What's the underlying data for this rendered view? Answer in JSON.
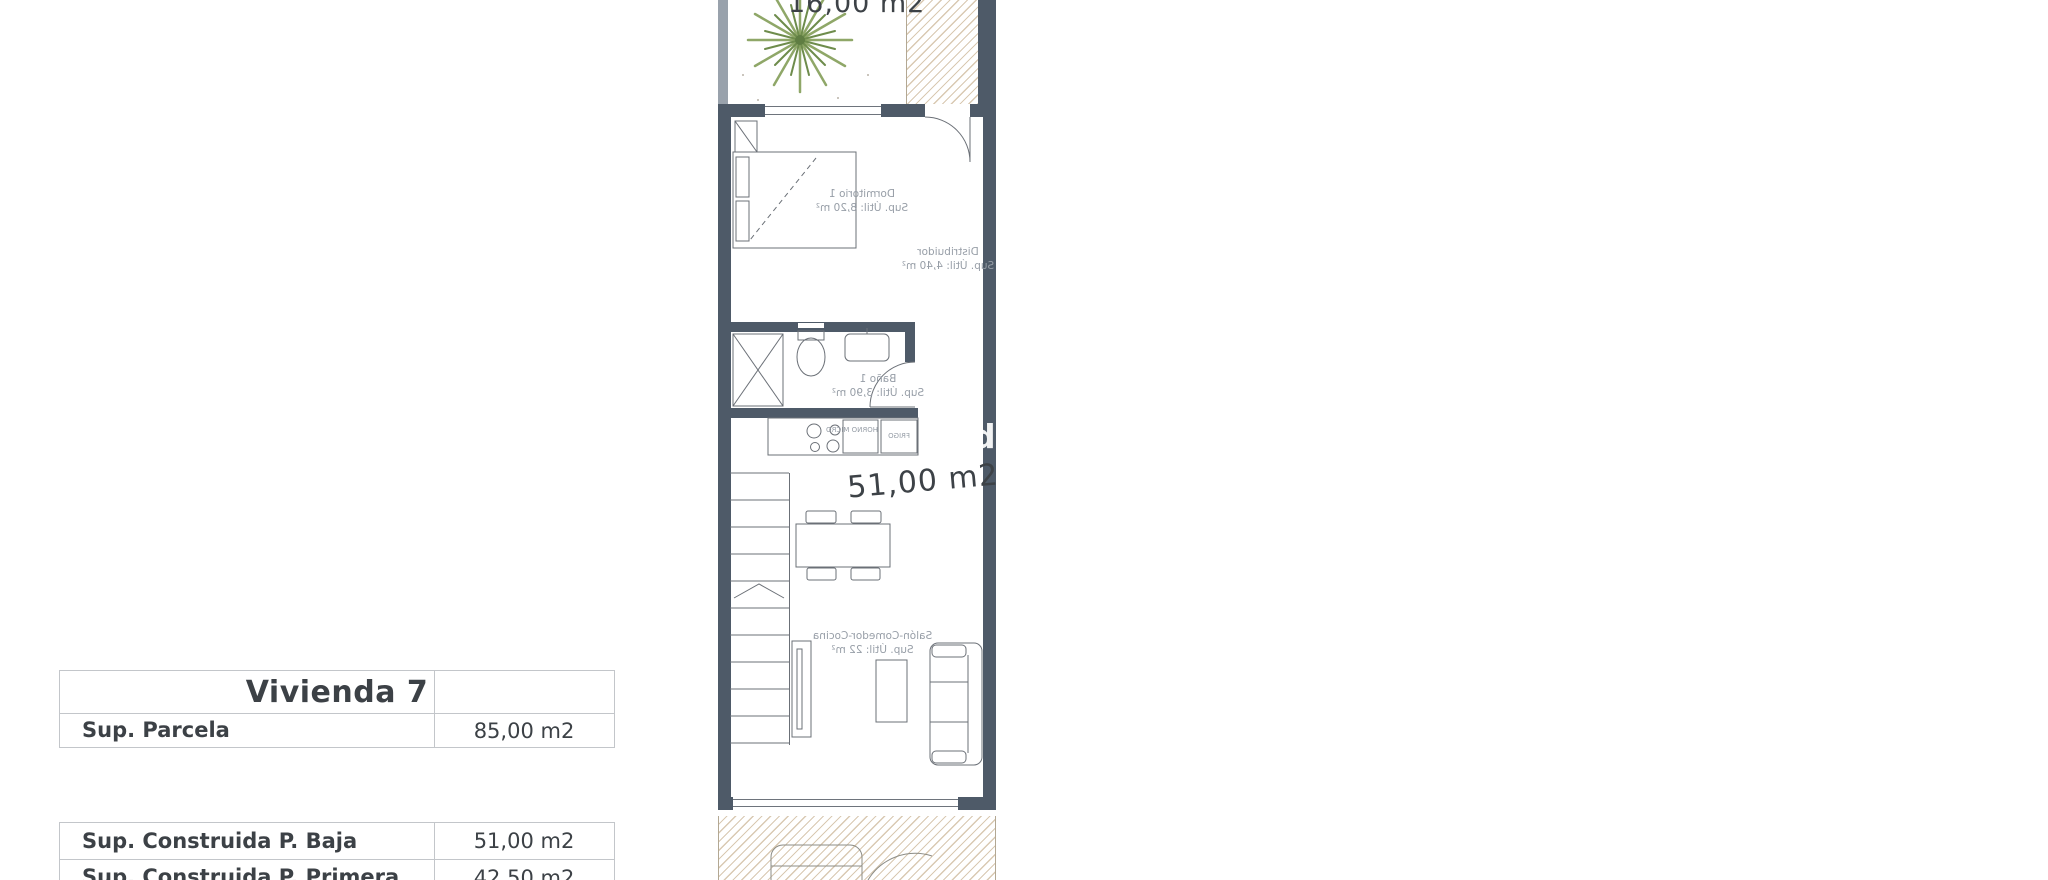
{
  "title_block": {
    "title": "Vivienda 7",
    "parcela": {
      "label": "Sup. Parcela",
      "value": "85,00 m2"
    },
    "construida_baja": {
      "label": "Sup. Construida P. Baja",
      "value": "51,00 m2"
    },
    "construida_primera": {
      "label": "Sup. Construida P. Primera",
      "value": "42,50 m2"
    }
  },
  "ground_floor": {
    "garden_area": "16,00 m2",
    "total_area": "51,00 m2",
    "dormitorio1": {
      "name": "Dormitorio 1",
      "area": "Sup. Útil: 8,20 m²"
    },
    "distribuidor": {
      "name": "Distribuidor",
      "area": "Sup. Útil: 4,40 m²"
    },
    "bano1": {
      "name": "Baño 1",
      "area": "Sup. Útil: 3,90 m²"
    },
    "salon": {
      "name": "Salón-Comedor-Cocina",
      "area": "Sup. Útil: 22 m²"
    },
    "kitchen": {
      "horno": "HORNO MICRO",
      "frigo": "FRIGO"
    }
  },
  "first_floor": {
    "dormitorio2_top": {
      "name": "Dormitorio 2",
      "area": "Sup. Útil: 11,30 m²"
    },
    "bano2": {
      "name": "Baño 2",
      "area": "Sup. Útil: 4,20 m²"
    },
    "dormitorio2_bottom": {
      "name": "Dormitorio 2",
      "area": "Sup. Útil: 11,20 m²"
    },
    "terraza": {
      "name": "Terraza",
      "area": "Sup. Útil: 8,80 m²"
    },
    "dims": {
      "shower_top_w": "0.90",
      "shower_top_d": "1.03",
      "wc_w": "0.90",
      "wc_room_w": "1.70",
      "bed_top": "2.02",
      "shower2": "1.88",
      "bano2_w": "2.21",
      "hall_top": "2.02",
      "hall_mid": "0.92",
      "stairs_w": "0.90",
      "bano2_bottom": "1.88",
      "hall_bottom": "1.02",
      "bed_bottom_h": "3.74",
      "bed_bottom_w": "3.00",
      "terraza_w": "4.15",
      "terraza_h": "1.78"
    }
  },
  "solarium": {
    "name": "Solarium",
    "area": "Sup. Útil: 32,30 m²",
    "dims": {
      "top": "4.60",
      "left": "8.57",
      "right": "5.73",
      "bottom": "2.90"
    }
  },
  "watermark": "din",
  "colors": {
    "wall": "#4e5a68",
    "dimension": "#8296ac",
    "hatch": "#d9c9b2",
    "tree_green": "#8fa768"
  }
}
